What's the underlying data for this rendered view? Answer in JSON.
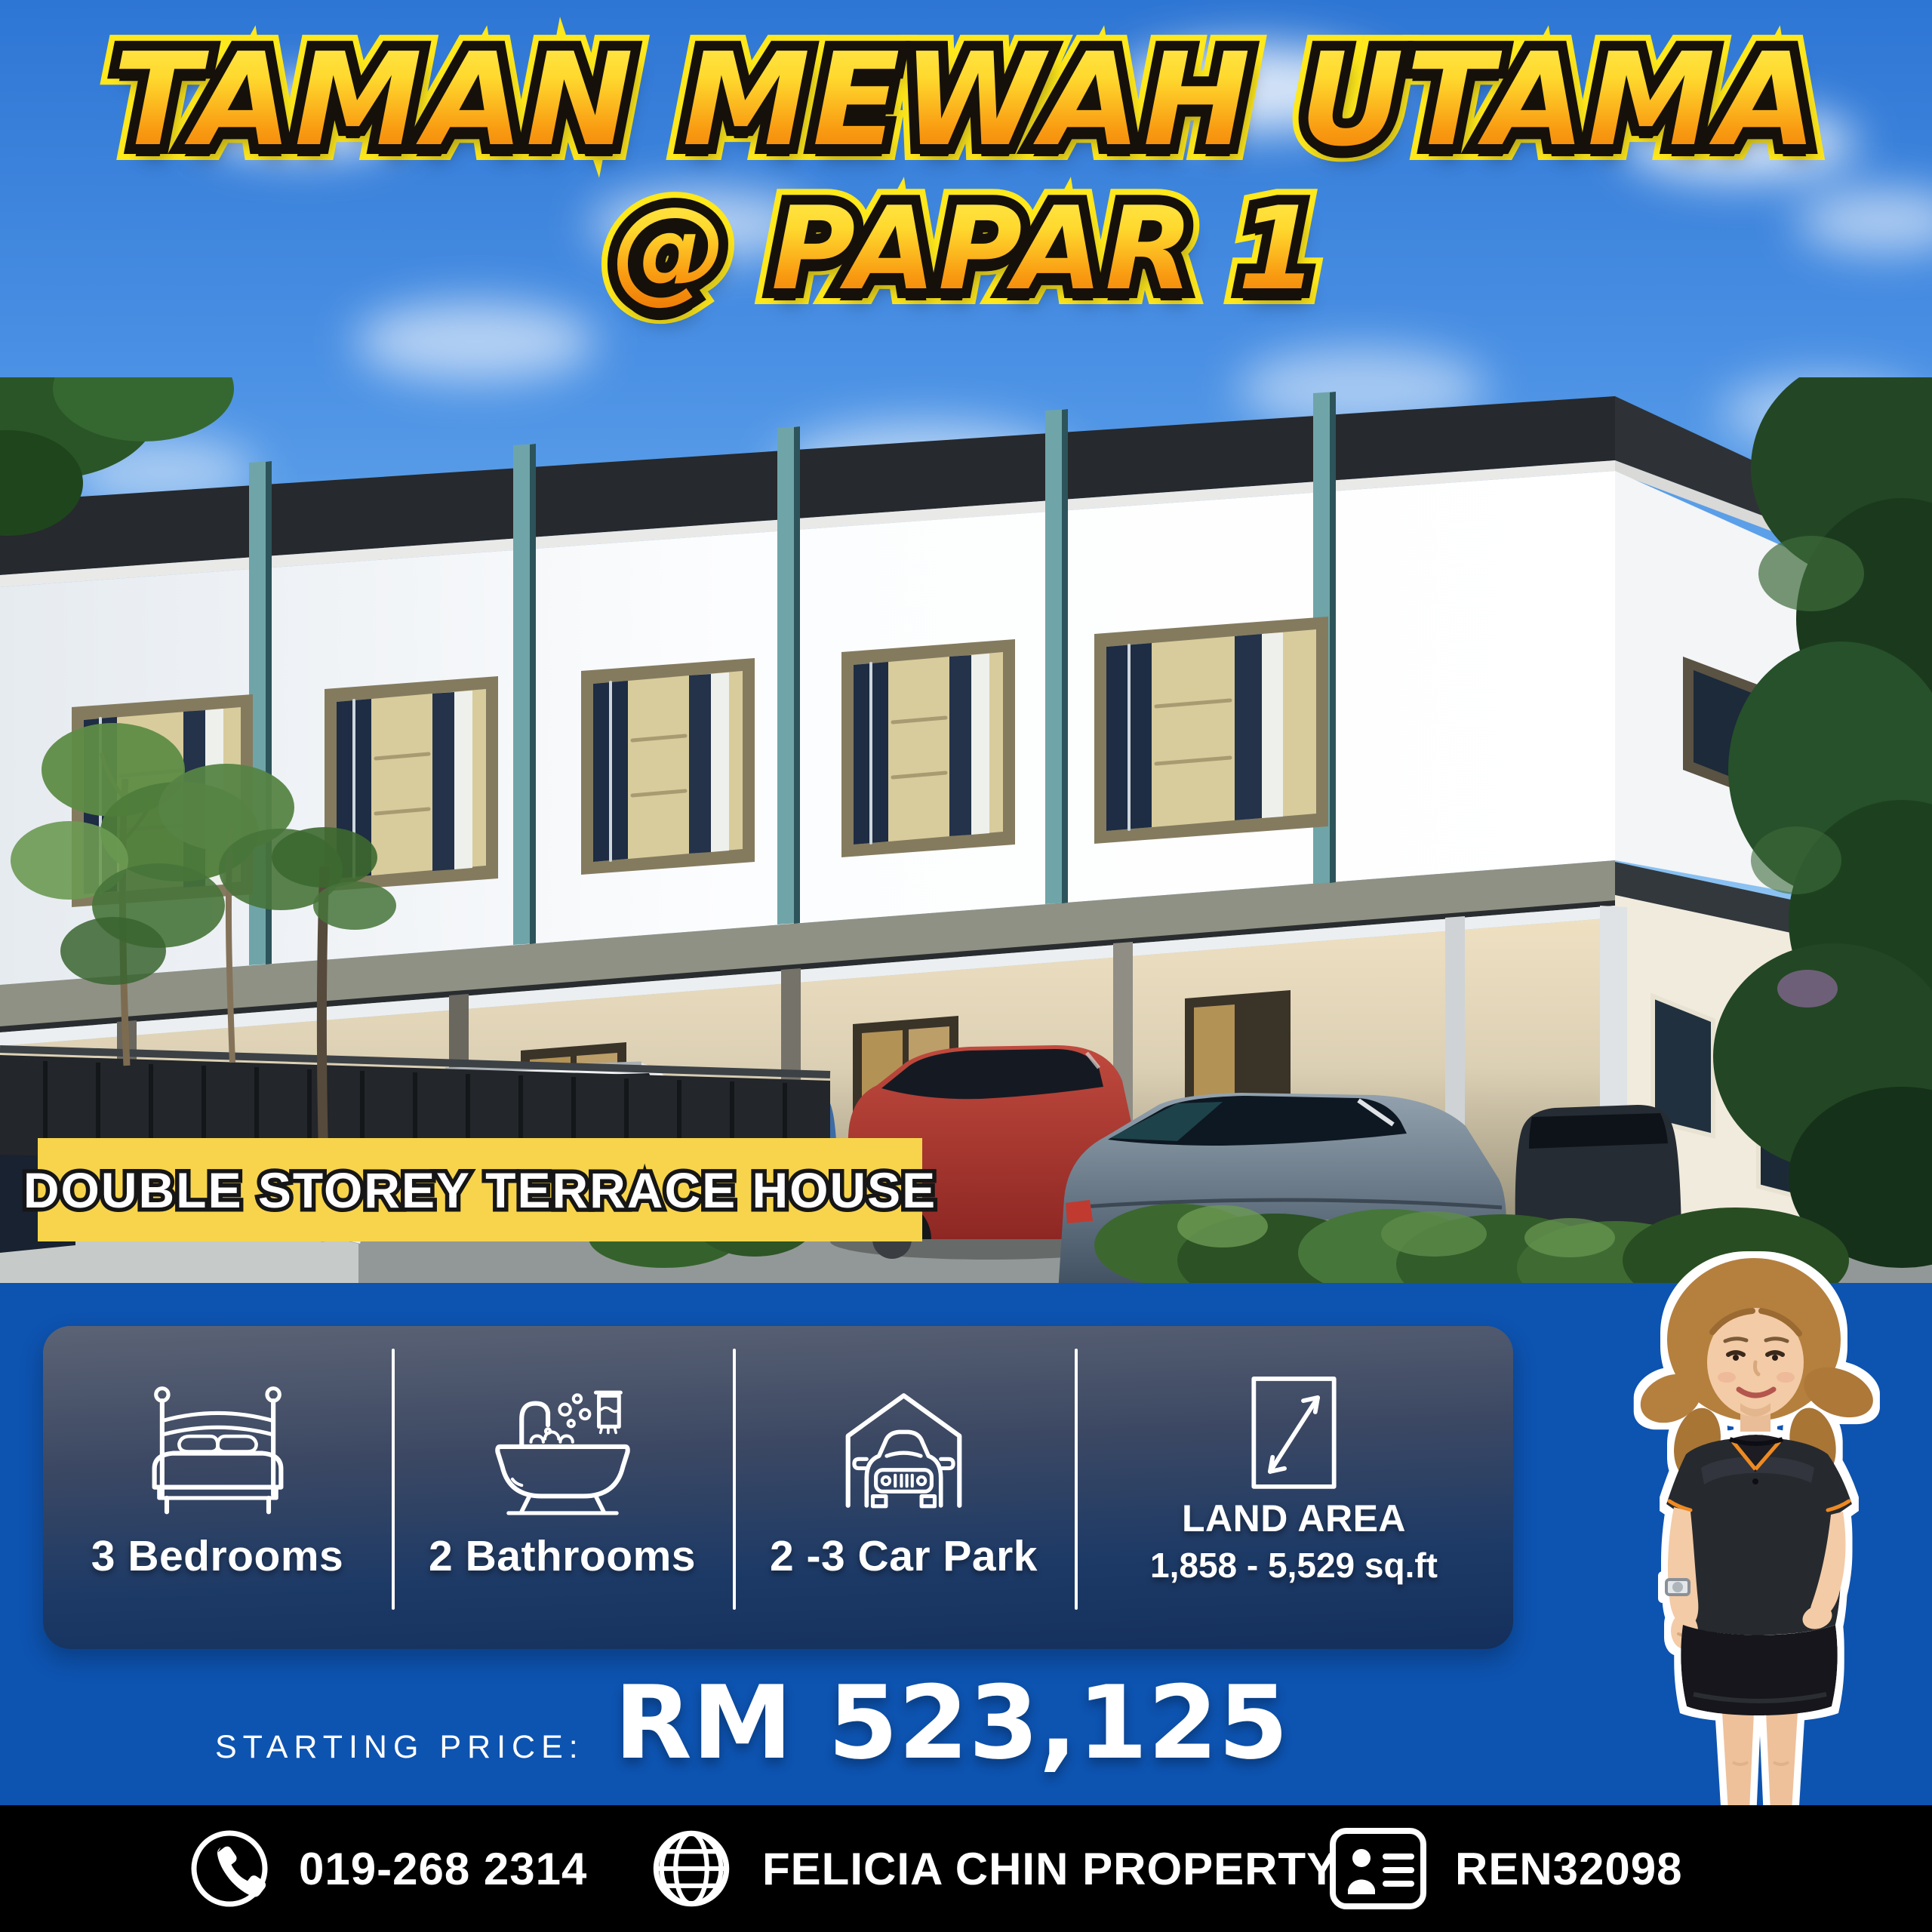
{
  "title": {
    "line1": "TAMAN MEWAH UTAMA",
    "line2": "@ PAPAR 1"
  },
  "banner": {
    "label": "DOUBLE STOREY TERRACE HOUSE"
  },
  "features": [
    {
      "icon": "bed-icon",
      "label": "3 Bedrooms"
    },
    {
      "icon": "bathtub-icon",
      "label": "2 Bathrooms"
    },
    {
      "icon": "car-park-icon",
      "label": "2 -3 Car Park"
    },
    {
      "icon": "land-area-icon",
      "label": "LAND AREA",
      "sublabel": "1,858 - 5,529 sq.ft"
    }
  ],
  "price": {
    "label": "STARTING PRICE:",
    "value": "RM 523,125"
  },
  "footer": [
    {
      "icon": "phone-icon",
      "label": "019-268 2314"
    },
    {
      "icon": "globe-icon",
      "label": "FELICIA CHIN PROPERTY"
    },
    {
      "icon": "id-card-icon",
      "label": "REN32098"
    }
  ],
  "colors": {
    "section_blue": "#0d53b0",
    "banner_yellow": "#f7d44b",
    "footer_black": "#000000",
    "panel_top": "#5b6375",
    "panel_bottom": "#142f5c",
    "title_gradient_top": "#ffe23a",
    "title_gradient_bottom": "#ef7d07",
    "title_outline": "#15100a",
    "title_glow": "#ffe81c"
  }
}
